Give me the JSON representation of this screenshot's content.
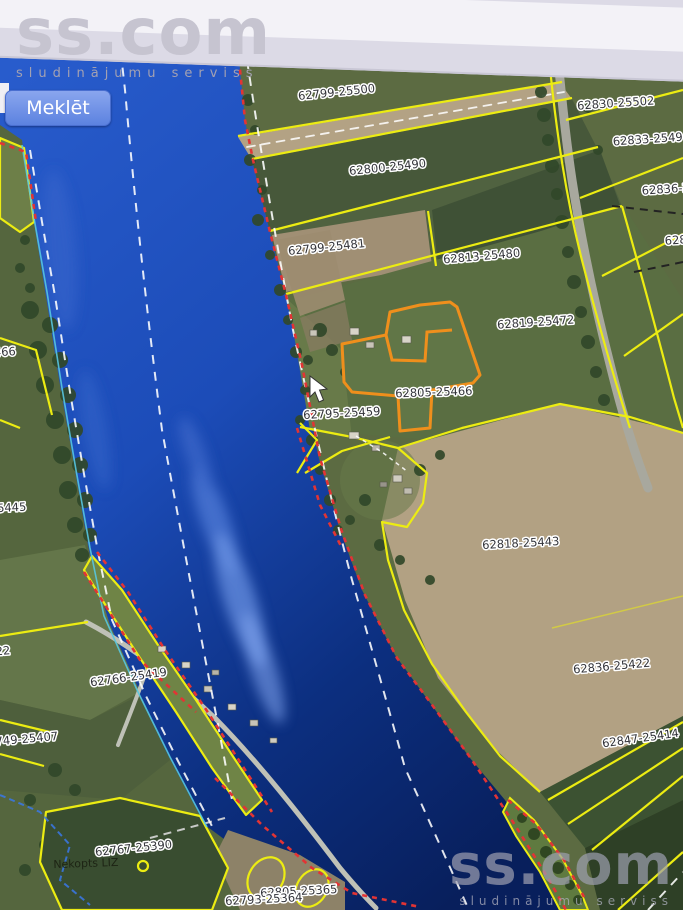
{
  "site": {
    "brand": "ss.com",
    "tagline": "sludinājumu serviss"
  },
  "search": {
    "button_label": "Meklēt"
  },
  "map": {
    "parcel_labels": [
      {
        "text": "62799-25500"
      },
      {
        "text": "62830-25502"
      },
      {
        "text": "62833-2549"
      },
      {
        "text": "62836-2"
      },
      {
        "text": "62800-25490"
      },
      {
        "text": "62799-25481"
      },
      {
        "text": "62813-25480"
      },
      {
        "text": "628"
      },
      {
        "text": "62819-25472"
      },
      {
        "text": "62805-25466"
      },
      {
        "text": "62795-25459"
      },
      {
        "text": "466"
      },
      {
        "text": "25445"
      },
      {
        "text": "62818-25443"
      },
      {
        "text": "62836-25422"
      },
      {
        "text": "62847-25414"
      },
      {
        "text": "22"
      },
      {
        "text": "62766-25419"
      },
      {
        "text": "749-25407"
      },
      {
        "text": "62767-25390"
      },
      {
        "text": "62805-25365"
      },
      {
        "text": "62793-25364"
      }
    ],
    "area_labels": [
      {
        "text": "Nekopts LIZ"
      }
    ],
    "colors": {
      "water_bright": "#2a5ecf",
      "water_deep": "#081f5c",
      "boundary_yellow": "#ecec12",
      "selected_orange": "#ef8f1c",
      "restriction_red": "#e23434",
      "survey_line_white": "#ffffff",
      "button_blue": "#5c82e0"
    }
  }
}
